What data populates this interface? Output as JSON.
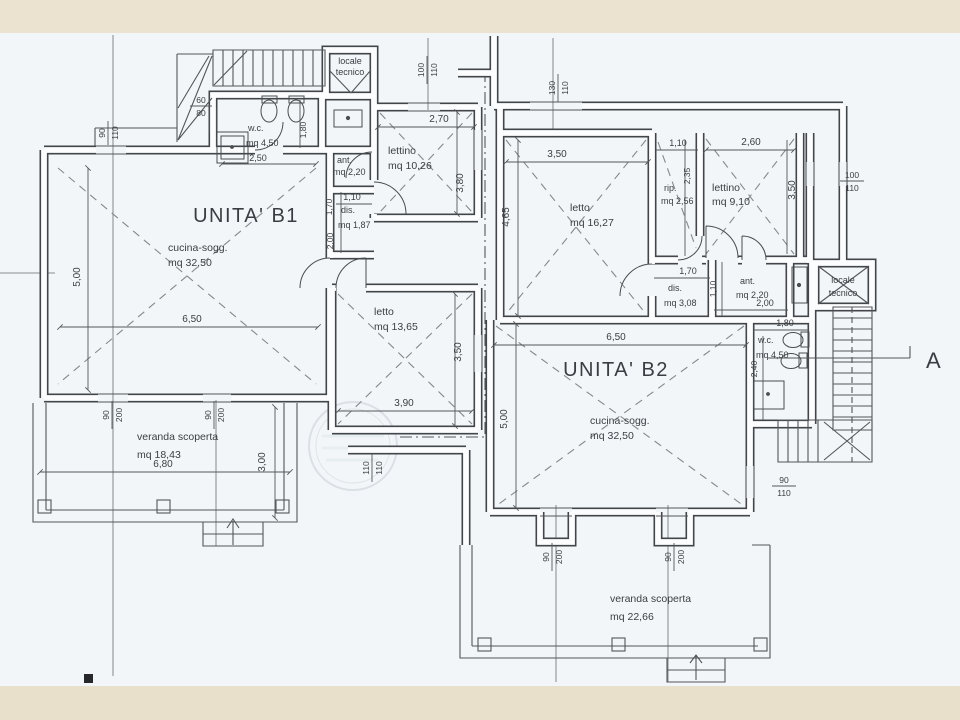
{
  "page": {
    "paper": "#f2f6f8",
    "band": "#ebe2cf",
    "ink": "#42454a"
  },
  "labels": {
    "b1_title": "UNITA' B1",
    "b1_cucina_name": "cucina-sogg.",
    "b1_cucina_area": "mq 32,50",
    "b1_dim_w": "6,50",
    "b1_dim_h": "5,00",
    "b1_wc_name": "w.c.",
    "b1_wc_area": "mq 4,50",
    "b1_wc_w": "2,50",
    "b1_wc_h": "1,80",
    "b1_wc_win_t": "60",
    "b1_wc_win_b": "80",
    "b1_win_t": "90",
    "b1_win_b": "110",
    "b1_locale_1": "locale",
    "b1_locale_2": "tecnico",
    "b1_lettino_name": "lettino",
    "b1_lettino_area": "mq 10,26",
    "b1_lettino_w": "2,70",
    "b1_lettino_h": "3,80",
    "b1_lettino_win_t": "100",
    "b1_lettino_win_b": "110",
    "b1_ant_name": "ant.",
    "b1_ant_area": "mq 2,20",
    "b1_dis_name": "dis.",
    "b1_dis_area": "mq 1,87",
    "b1_dis_w": "1,10",
    "b1_dis_h": "1,70",
    "b1_corr_h": "2,00",
    "b1_letto_name": "letto",
    "b1_letto_area": "mq 13,65",
    "b1_letto_w": "3,90",
    "b1_letto_h": "3,50",
    "b1_ver_name": "veranda scoperta",
    "b1_ver_area": "mq 18,43",
    "b1_ver_w": "6,80",
    "b1_ver_h": "3,00",
    "b1_door1_t": "90",
    "b1_door1_b": "200",
    "b1_door2_t": "90",
    "b1_door2_b": "200",
    "mid_win_t": "110",
    "mid_win_b": "110",
    "top_win_t": "130",
    "top_win_b": "110",
    "b2_title": "UNITA' B2",
    "b2_letto_name": "letto",
    "b2_letto_area": "mq 16,27",
    "b2_letto_w": "3,50",
    "b2_letto_h": "4,65",
    "b2_rip_name": "rip.",
    "b2_rip_area": "mq 2,56",
    "b2_rip_w": "1,10",
    "b2_rip_h": "2,35",
    "b2_lettino_name": "lettino",
    "b2_lettino_area": "mq 9,10",
    "b2_lettino_w": "2,60",
    "b2_lettino_h": "3,50",
    "b2_win_r_t": "100",
    "b2_win_r_b": "110",
    "b2_dis_name": "dis.",
    "b2_dis_area": "mq 3,08",
    "b2_dis_w": "1,70",
    "b2_ant_name": "ant.",
    "b2_ant_area": "mq 2,20",
    "b2_ant_w": "2,00",
    "b2_ant_h": "1,10",
    "b2_wc_name": "w.c.",
    "b2_wc_area": "mq 4,50",
    "b2_wc_w": "1,80",
    "b2_wc_h": "2,40",
    "b2_locale_1": "locale",
    "b2_locale_2": "tecnico",
    "b2_cucina_name": "cucina-sogg.",
    "b2_cucina_area": "mq 32,50",
    "b2_cucina_w": "6,50",
    "b2_cucina_h": "5,00",
    "b2_ver_name": "veranda scoperta",
    "b2_ver_area": "mq 22,66",
    "b2_door1_t": "90",
    "b2_door1_b": "200",
    "b2_door2_t": "90",
    "b2_door2_b": "200",
    "b2_win_br_t": "90",
    "b2_win_br_b": "110",
    "section": "A"
  }
}
